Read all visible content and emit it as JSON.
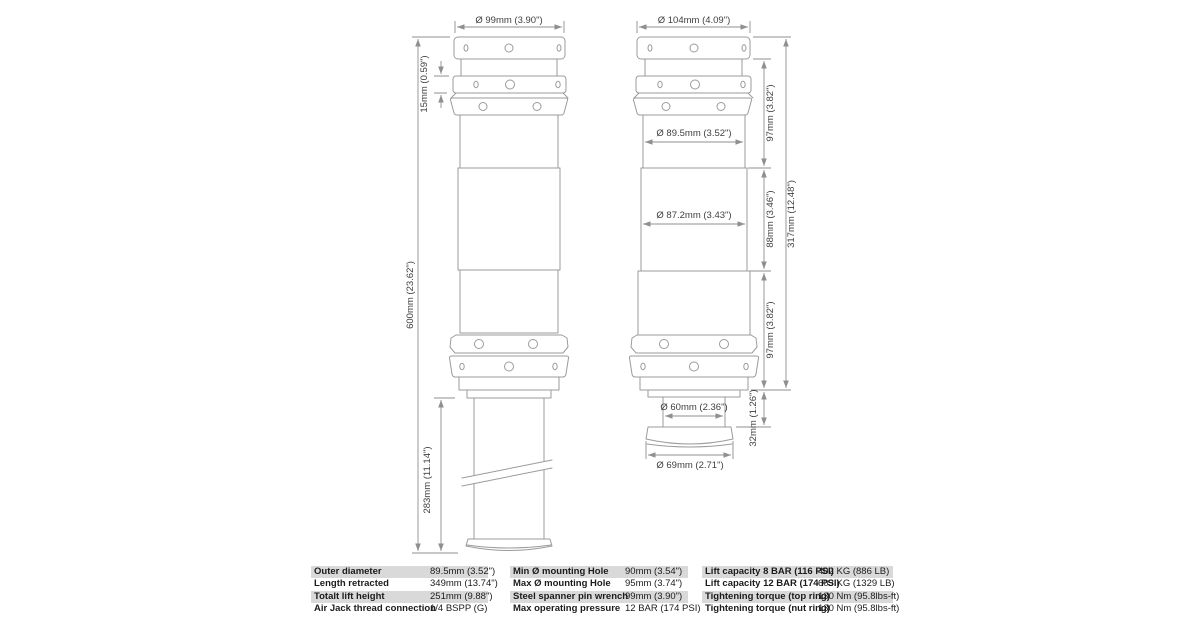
{
  "dims": {
    "ext_top_width": "Ø  99mm (3.90\")",
    "ext_ring_height": "15mm (0.59\")",
    "ext_total_height": "600mm (23.62\")",
    "ext_rod_length": "283mm (11.14\")",
    "ret_top_width": "Ø  104mm (4.09\")",
    "ret_upper_dia": "Ø  89.5mm (3.52\")",
    "ret_mid_dia": "Ø  87.2mm (3.43\")",
    "ret_upper_h": "97mm (3.82\")",
    "ret_mid_h": "88mm (3.46\")",
    "ret_total_h": "317mm (12.48\")",
    "ret_lower_h": "97mm (3.82\")",
    "ret_stub_h": "32mm (1.26\")",
    "ret_stub_dia": "Ø  60mm (2.36\")",
    "ret_foot_dia": "Ø  69mm (2.71\")"
  },
  "spec_table": {
    "groups": [
      {
        "rows": [
          {
            "label": "Outer diameter",
            "value": "89.5mm (3.52\")"
          },
          {
            "label": "Length retracted",
            "value": "349mm (13.74\")"
          },
          {
            "label": "Totalt lift height",
            "value": "251mm (9.88\")"
          },
          {
            "label": "Air Jack thread connection",
            "value": "1/4 BSPP (G)"
          }
        ]
      },
      {
        "rows": [
          {
            "label": "Min Ø mounting Hole",
            "value": "90mm (3.54\")"
          },
          {
            "label": "Max Ø mounting Hole",
            "value": "95mm (3.74\")"
          },
          {
            "label": "Steel spanner pin wrench",
            "value": "99mm (3.90\")"
          },
          {
            "label": "Max operating pressure",
            "value": "12 BAR (174 PSI)"
          }
        ]
      },
      {
        "rows": [
          {
            "label": "Lift capacity 8 BAR (116 PSI)",
            "value": "402 KG (886 LB)"
          },
          {
            "label": "Lift capacity 12 BAR (174 PSI)",
            "value": "603 KG (1329 LB)"
          },
          {
            "label": "Tightening torque (top ring)",
            "value": "130 Nm (95.8lbs-ft)"
          },
          {
            "label": "Tightening torque (nut ring)",
            "value": "130 Nm (95.8lbs-ft)"
          }
        ]
      }
    ]
  }
}
